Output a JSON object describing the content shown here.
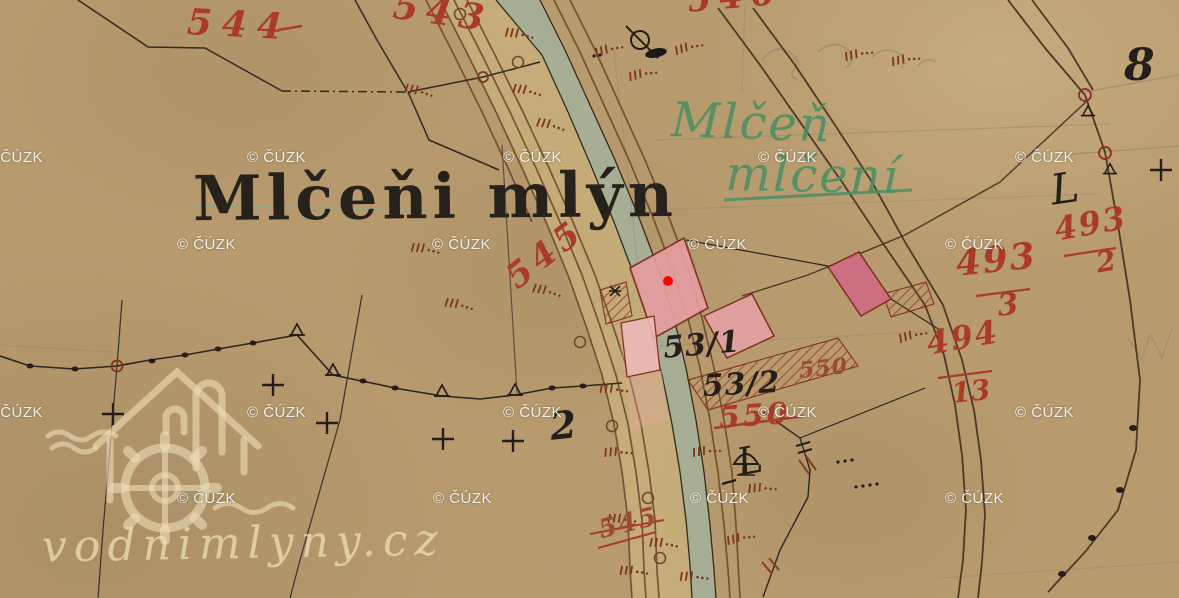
{
  "title": {
    "text": "Mlčeňi mlýn"
  },
  "logo": {
    "text": "vodnimlyny.cz"
  },
  "watermark": {
    "label": "© ČÚZK",
    "positions": [
      [
        -16,
        149
      ],
      [
        247,
        149
      ],
      [
        503,
        149
      ],
      [
        758,
        149
      ],
      [
        1015,
        149
      ],
      [
        177,
        236
      ],
      [
        432,
        236
      ],
      [
        688,
        236
      ],
      [
        945,
        236
      ],
      [
        -16,
        404
      ],
      [
        247,
        404
      ],
      [
        503,
        404
      ],
      [
        758,
        404
      ],
      [
        1015,
        404
      ],
      [
        177,
        490
      ],
      [
        433,
        490
      ],
      [
        690,
        490
      ],
      [
        945,
        490
      ]
    ]
  },
  "map_labels": [
    {
      "text": "544",
      "x": 188,
      "y": 4,
      "size": 36,
      "rot": 3,
      "cls": "red",
      "ls": 10,
      "name": "parcel-number-544"
    },
    {
      "text": "543",
      "x": 396,
      "y": -12,
      "size": 36,
      "rot": 8,
      "cls": "red",
      "ls": 8,
      "name": "parcel-number-543"
    },
    {
      "text": "546",
      "x": 686,
      "y": -16,
      "size": 34,
      "rot": -5,
      "cls": "red",
      "ls": 8,
      "name": "parcel-number-546"
    },
    {
      "text": "545",
      "x": 500,
      "y": 268,
      "size": 34,
      "rot": -38,
      "cls": "red",
      "ls": 6,
      "name": "parcel-number-545"
    },
    {
      "text": "493",
      "x": 1052,
      "y": 214,
      "size": 32,
      "rot": -10,
      "cls": "red",
      "ls": 2,
      "name": "parcel-number-493-a"
    },
    {
      "text": "2",
      "x": 1094,
      "y": 250,
      "size": 28,
      "rot": -10,
      "cls": "red",
      "ls": 0,
      "name": "parcel-fraction-2"
    },
    {
      "text": "493",
      "x": 954,
      "y": 246,
      "size": 36,
      "rot": -6,
      "cls": "red",
      "ls": 2,
      "name": "parcel-number-493-b"
    },
    {
      "text": "3",
      "x": 996,
      "y": 292,
      "size": 30,
      "rot": -6,
      "cls": "red",
      "ls": 0,
      "name": "parcel-fraction-3"
    },
    {
      "text": "494",
      "x": 924,
      "y": 328,
      "size": 32,
      "rot": -10,
      "cls": "red",
      "ls": 2,
      "name": "parcel-number-494"
    },
    {
      "text": "13",
      "x": 950,
      "y": 380,
      "size": 28,
      "rot": -6,
      "cls": "red",
      "ls": 0,
      "name": "parcel-fraction-13"
    },
    {
      "text": "550",
      "x": 798,
      "y": 360,
      "size": 22,
      "rot": -6,
      "cls": "red2",
      "ls": 1,
      "name": "parcel-number-550-small"
    },
    {
      "text": "550",
      "x": 718,
      "y": 404,
      "size": 30,
      "rot": -4,
      "cls": "red",
      "ls": 3,
      "name": "parcel-number-550"
    },
    {
      "text": "545",
      "x": 596,
      "y": 518,
      "size": 26,
      "rot": -14,
      "cls": "red2",
      "ls": 2,
      "name": "parcel-number-545-scribble"
    },
    {
      "text": "53/1",
      "x": 662,
      "y": 334,
      "size": 30,
      "rot": -5,
      "cls": "black",
      "ls": 1,
      "name": "parcel-number-53-1"
    },
    {
      "text": "53/2",
      "x": 702,
      "y": 372,
      "size": 30,
      "rot": -3,
      "cls": "black",
      "ls": 1,
      "name": "parcel-number-53-2"
    },
    {
      "text": "2",
      "x": 548,
      "y": 408,
      "size": 38,
      "rot": -6,
      "cls": "black",
      "ls": 0,
      "name": "parcel-number-2"
    },
    {
      "text": "8",
      "x": 1124,
      "y": 44,
      "size": 44,
      "rot": 0,
      "cls": "black",
      "ls": 0,
      "name": "sheet-number-8"
    },
    {
      "text": "L",
      "x": 1048,
      "y": 170,
      "size": 42,
      "rot": -8,
      "cls": "black script",
      "ls": 0,
      "name": "script-letter-l-a"
    },
    {
      "text": "L",
      "x": 734,
      "y": 444,
      "size": 38,
      "rot": -10,
      "cls": "black script",
      "ls": 0,
      "name": "script-letter-l-b"
    },
    {
      "text": "Mlčeň",
      "x": 672,
      "y": 96,
      "size": 48,
      "rot": 2,
      "cls": "green",
      "ls": 2,
      "name": "place-name-mlcen"
    },
    {
      "text": "mlčení",
      "x": 726,
      "y": 150,
      "size": 48,
      "rot": 1,
      "cls": "green",
      "ls": 2,
      "name": "place-name-mlceni-struck"
    }
  ],
  "colors": {
    "paper": "#b89b6e",
    "stream": "#a4b29b",
    "road_band": "#cdb67e",
    "ink_brown": "#6f4a2a",
    "ink_dark": "#2e2620",
    "red_ink": "#ab3b28",
    "green_ink": "#4a8e62",
    "building_pink": "#e59da0",
    "building_dark_pink": "#cf6d82",
    "marker_red": "#ff0000",
    "watermark_cream": "#ebdcb4"
  }
}
